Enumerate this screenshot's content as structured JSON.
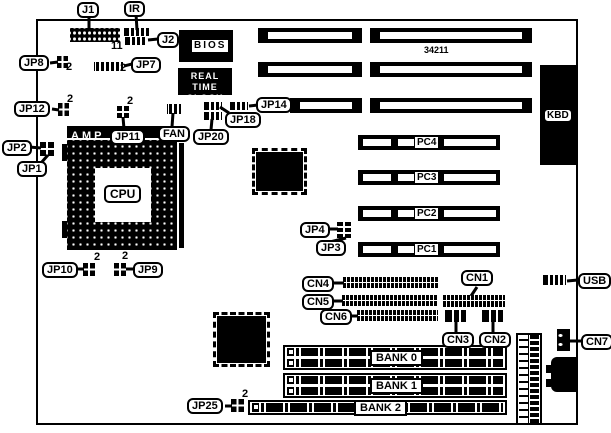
{
  "pin2": "2",
  "annotations": {
    "j1_pin": "11",
    "board_number": "34211"
  },
  "callouts": {
    "j1": "J1",
    "ir": "IR",
    "j2": "J2",
    "jp1": "JP1",
    "jp2": "JP2",
    "jp3": "JP3",
    "jp4": "JP4",
    "jp7": "JP7",
    "jp8": "JP8",
    "jp9": "JP9",
    "jp10": "JP10",
    "jp11": "JP11",
    "jp12": "JP12",
    "jp14": "JP14",
    "jp18": "JP18",
    "jp20": "JP20",
    "jp25": "JP25",
    "cn1": "CN1",
    "cn2": "CN2",
    "cn3": "CN3",
    "cn4": "CN4",
    "cn5": "CN5",
    "cn6": "CN6",
    "cn7": "CN7",
    "usb": "USB",
    "fan": "FAN"
  },
  "chips": {
    "bios": "BIOS",
    "rtc_line1": "REAL TIME",
    "rtc_line2": "CLOCK",
    "amp": "AMP",
    "cpu": "CPU",
    "kbd": "KBD"
  },
  "slots": {
    "pc1": "PC1",
    "pc2": "PC2",
    "pc3": "PC3",
    "pc4": "PC4",
    "bank0": "BANK 0",
    "bank1": "BANK 1",
    "bank2": "BANK 2"
  }
}
